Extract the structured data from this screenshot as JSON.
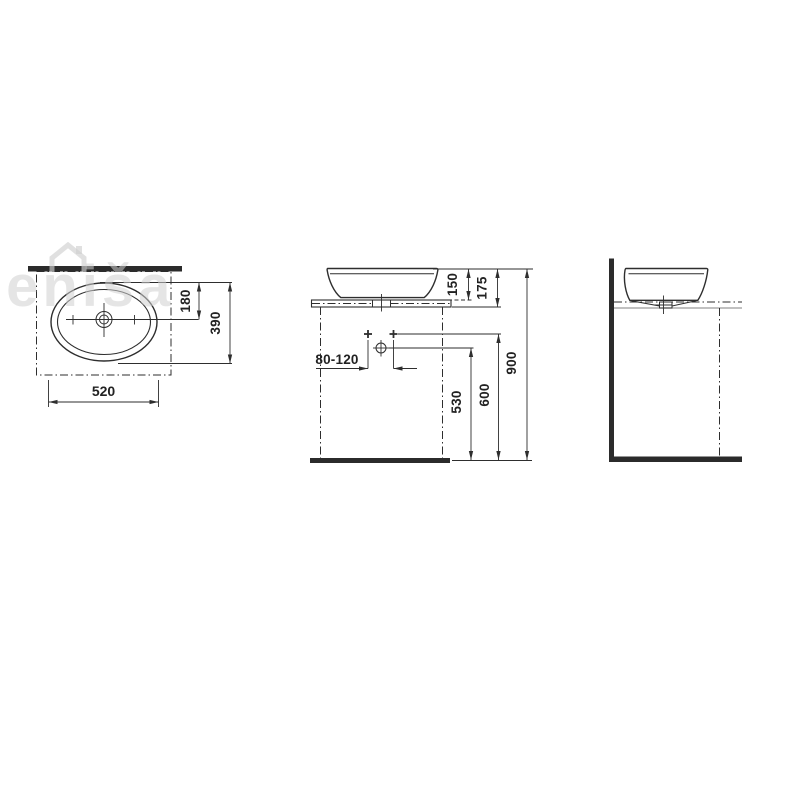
{
  "watermark": {
    "text": "jeniša"
  },
  "top_view": {
    "dim_drain_offset": "180",
    "dim_depth": "390",
    "dim_width": "520"
  },
  "front_view": {
    "dim_basin_height": "150",
    "dim_rim_to_counter_bottom": "175",
    "dim_rim_to_floor": "900",
    "dim_trap_height": "530",
    "dim_supply_height": "600",
    "dim_drain_offset_range": "80-120"
  },
  "colors": {
    "line": "#2e2e2e",
    "light_line": "#9b9b9b",
    "watermark": "#d0d0d0",
    "background": "#ffffff"
  }
}
